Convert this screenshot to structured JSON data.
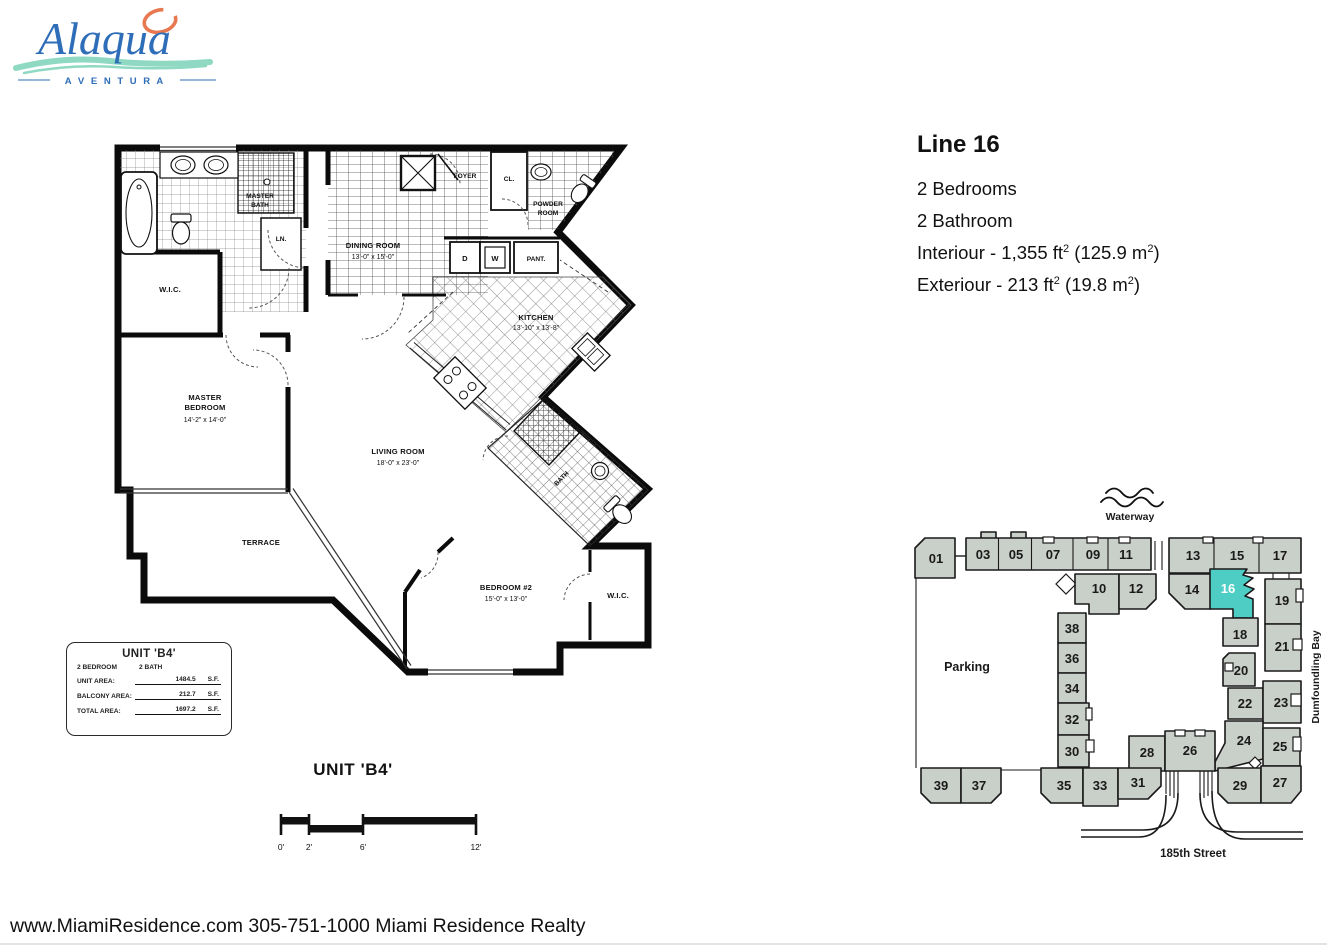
{
  "logo": {
    "brand": "Alaqua",
    "subtitle": "A V E N T U R A"
  },
  "colors": {
    "accent_teal": "#4ecdc4",
    "building_gray": "#c9cfc9",
    "logo_blue": "#2e6db8",
    "logo_orange": "#e8784f",
    "logo_teal": "#8fd9c2"
  },
  "details": {
    "title": "Line 16",
    "bedrooms": "2 Bedrooms",
    "bathrooms": "2 Bathroom",
    "interior": {
      "pre": "Interiour - 1,355 ft",
      "sup1": "2",
      "mid": " (125.9 m",
      "sup2": "2",
      "post": ")"
    },
    "exterior": {
      "pre": "Exteriour - 213 ft",
      "sup1": "2",
      "mid": " (19.8 m",
      "sup2": "2",
      "post": ")"
    }
  },
  "floorplan": {
    "rooms": {
      "master_bath": [
        "MASTER",
        "BATH"
      ],
      "wic_master": "W.I.C.",
      "linen": "LN.",
      "foyer": "FOYER",
      "closet": "CL.",
      "powder": [
        "POWDER",
        "ROOM"
      ],
      "dining": [
        "DINING ROOM",
        "13'-0\" x 15'-0\""
      ],
      "dryer": "D",
      "washer": "W",
      "pantry": "PANT.",
      "kitchen": [
        "KITCHEN",
        "13'-10\" x 13'-8\""
      ],
      "master_bedroom": [
        "MASTER",
        "BEDROOM",
        "14'-2\" x 14'-0\""
      ],
      "living": [
        "LIVING ROOM",
        "18'-0\" x 23'-0\""
      ],
      "terrace": "TERRACE",
      "bedroom2": [
        "BEDROOM #2",
        "15'-0\" x 13'-0\""
      ],
      "bath2": "BATH",
      "wic_bedroom2": "W.I.C."
    },
    "title": "UNIT 'B4'",
    "scale_ticks": [
      "0'",
      "2'",
      "6'",
      "12'"
    ]
  },
  "unit_box": {
    "title": "UNIT 'B4'",
    "bed": "2 BEDROOM",
    "bath": "2 BATH",
    "rows": [
      {
        "label": "UNIT AREA:",
        "value": "1484.5",
        "unit": "S.F."
      },
      {
        "label": "BALCONY AREA:",
        "value": "212.7",
        "unit": "S.F."
      },
      {
        "label": "TOTAL AREA:",
        "value": "1697.2",
        "unit": "S.F."
      }
    ]
  },
  "site_plan": {
    "waterway": "Waterway",
    "street": "185th Street",
    "bay": "Dumfoundling Bay",
    "parking": "Parking",
    "highlighted": "16",
    "units": [
      "01",
      "03",
      "05",
      "07",
      "09",
      "11",
      "13",
      "15",
      "17",
      "10",
      "12",
      "14",
      "16",
      "19",
      "18",
      "21",
      "20",
      "22",
      "23",
      "24",
      "25",
      "38",
      "36",
      "34",
      "32",
      "30",
      "28",
      "26",
      "39",
      "37",
      "35",
      "33",
      "31",
      "29",
      "27"
    ]
  },
  "footer": "www.MiamiResidence.com 305-751-1000 Miami Residence Realty"
}
